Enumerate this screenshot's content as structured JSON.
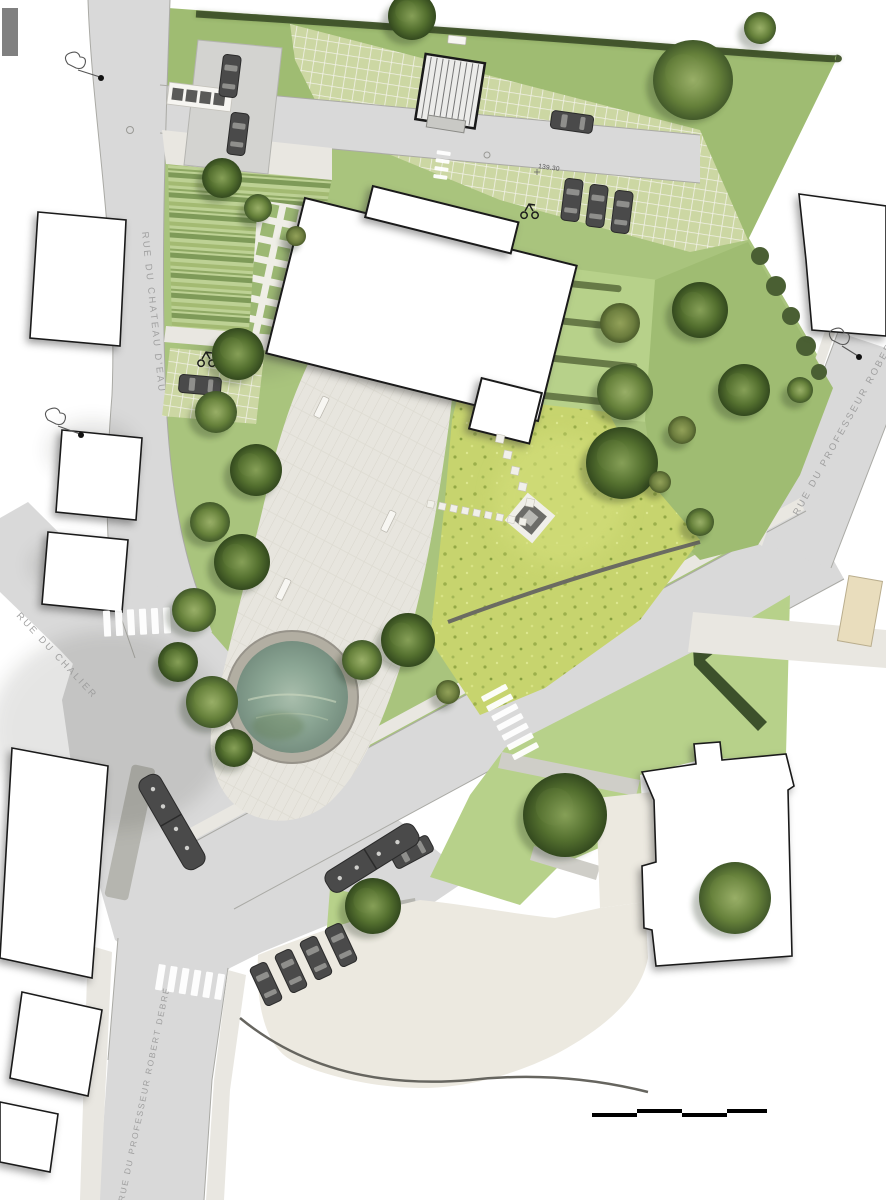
{
  "drawing": {
    "kind": "landscape site plan",
    "streets": {
      "chateau_deau": "RUE DU CHATEAU D'EAU",
      "prof_robert_debre_east": "RUE DU PROFESSEUR ROBERT DEBRÉ",
      "chalier": "RUE DU CHALIER",
      "prof_robert_debre_south": "RUE DU PROFESSEUR ROBERT DEBRÉ"
    },
    "annotations": {
      "spot_elevation": "139.30"
    },
    "scale_bar": {
      "segments": 4
    }
  },
  "icons": [
    "entrance-gate",
    "scooter-icon",
    "streetlamp-sketch-icon",
    "manhole-icon",
    "tree",
    "hedge",
    "pond",
    "fountain-square",
    "bench",
    "bus",
    "car",
    "crosswalk",
    "scale-bar",
    "stepping-stones"
  ],
  "colors": {
    "street": "#d9d9d9",
    "lawn": "#a9c47d",
    "bright_lawn": "#b7d18a",
    "meadow": "#c7d46e",
    "grass_paver": "#ccd7a3",
    "plaza": "#e7e5de",
    "cream_paving": "#ece9e0",
    "water": "#8ba694",
    "tree_dark": "#46602e",
    "hedge": "#42552c",
    "building_fill": "#ffffff",
    "building_outline": "#1a1a1a",
    "vehicle": "#4a4a4a",
    "label_grey": "#9a9a9a"
  }
}
